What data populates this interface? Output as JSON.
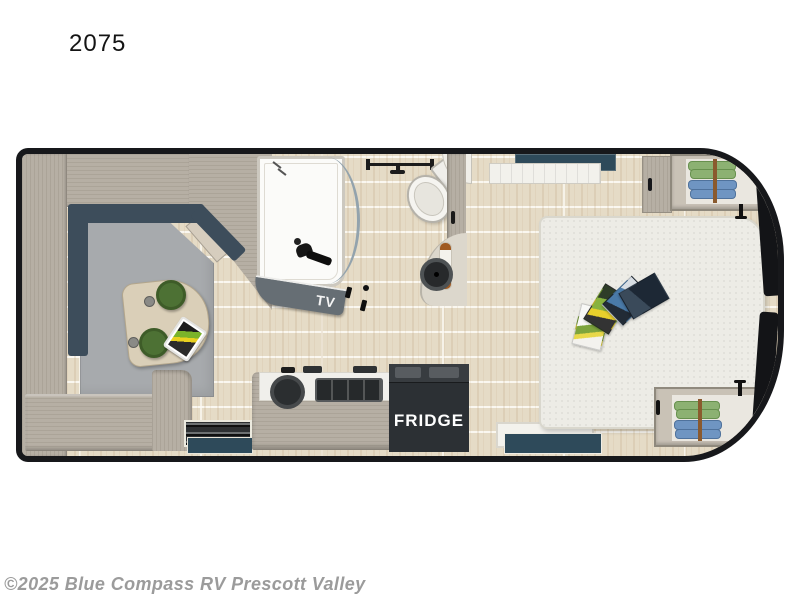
{
  "page": {
    "model_number": "2075",
    "watermark": "©2025 Blue Compass RV Prescott Valley"
  },
  "floorplan": {
    "labels": {
      "tv": "TV",
      "fridge": "FRIDGE"
    },
    "colors": {
      "wall_outline": "#17181b",
      "floor_base": "#e5dbc6",
      "wood": "#b6afa4",
      "wood_light": "#c9c2b6",
      "table_wood": "#dacfb8",
      "sofa_seat": "#a7aaad",
      "sofa_back": "#3d4d5b",
      "stool_green": "#4d7134",
      "window_teal": "#2e4a5a",
      "tv_band": "#666e74",
      "fridge_box": "#2c3034",
      "bed_fabric": "#edece6",
      "clothes_green": "#8cb172",
      "clothes_blue": "#6f95c2",
      "hanger_rod": "#8a5a2e",
      "shower_white": "#fbfbf9",
      "fixture_dark": "#161616"
    }
  }
}
